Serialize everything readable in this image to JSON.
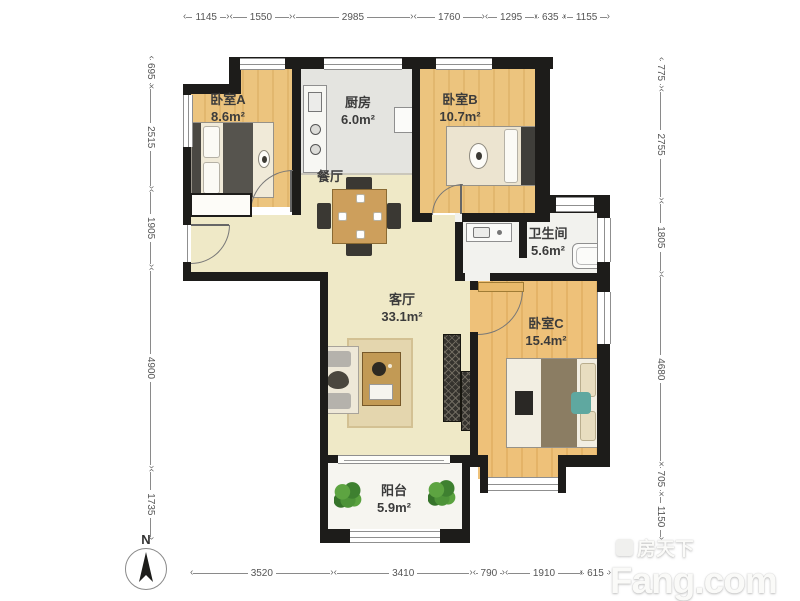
{
  "rooms": {
    "bedroom_a": {
      "name": "卧室A",
      "area": "8.6m²"
    },
    "kitchen": {
      "name": "厨房",
      "area": "6.0m²"
    },
    "bedroom_b": {
      "name": "卧室B",
      "area": "10.7m²"
    },
    "dining": {
      "name": "餐厅"
    },
    "bathroom": {
      "name": "卫生间",
      "area": "5.6m²"
    },
    "living": {
      "name": "客厅",
      "area": "33.1m²"
    },
    "bedroom_c": {
      "name": "卧室C",
      "area": "15.4m²"
    },
    "balcony": {
      "name": "阳台",
      "area": "5.9m²"
    }
  },
  "dimensions": {
    "top": [
      1145,
      1550,
      2985,
      1760,
      1295,
      635,
      1155
    ],
    "left": [
      695,
      2515,
      1905,
      4900,
      1735
    ],
    "right": [
      775,
      2755,
      1805,
      4680,
      705,
      1150
    ],
    "bottom": [
      3520,
      3410,
      790,
      1910,
      615
    ]
  },
  "compass": {
    "label": "N"
  },
  "watermark": {
    "brand_cn": "房天下",
    "brand_en": "Fang.com"
  },
  "colors": {
    "wall": "#1d1c1a",
    "bedroom_floor": "#eac27b",
    "living_floor": "#efe9c7",
    "kitchen_floor": "#e4e4e0",
    "bath_floor": "#f2f2ee",
    "balcony_floor": "#f6f5f0",
    "plant": "#4d9338",
    "dimension_text": "#555555"
  }
}
